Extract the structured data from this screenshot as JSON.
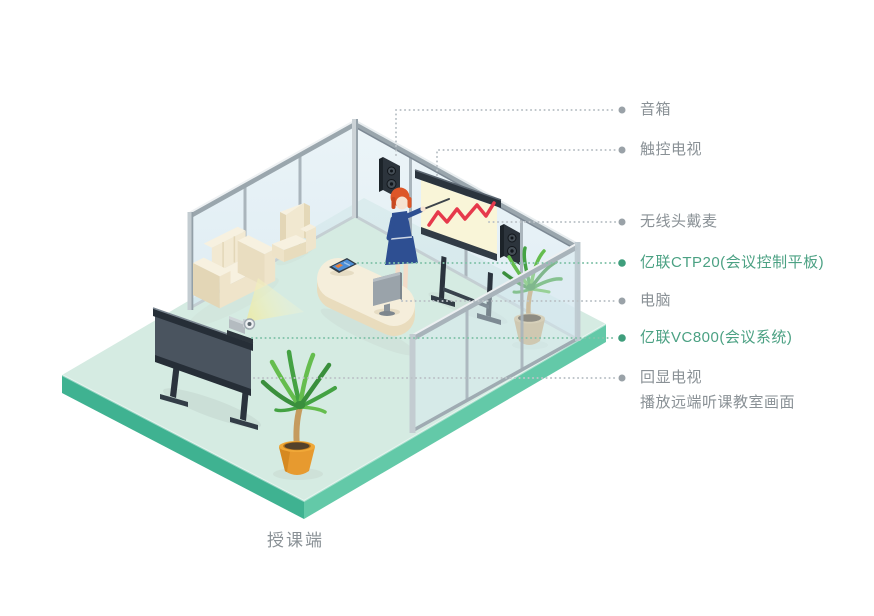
{
  "caption": {
    "text": "授课端"
  },
  "labels": [
    {
      "id": "speaker",
      "text": "音箱",
      "accent": false
    },
    {
      "id": "touch-tv",
      "text": "触控电视",
      "accent": false
    },
    {
      "id": "wireless-headset-mic",
      "text": "无线头戴麦",
      "accent": false
    },
    {
      "id": "yealink-ctp20",
      "text": "亿联CTP20(会议控制平板)",
      "accent": true
    },
    {
      "id": "computer",
      "text": "电脑",
      "accent": false
    },
    {
      "id": "yealink-vc800",
      "text": "亿联VC800(会议系统)",
      "accent": true
    },
    {
      "id": "echo-tv",
      "text": "回显电视",
      "sub": "播放远端听课教室画面",
      "accent": false
    }
  ],
  "colors": {
    "accent_green": "#4BA183",
    "label_gray": "#8A9196",
    "leader_dot_gray": "#9AA2A8",
    "leader_dot_green": "#3F9E7C",
    "platform_side_left": "#3FB291",
    "platform_side_right": "#63C9A8",
    "floor_mint": "#D5EBE2",
    "glass_blue": "#DCECF3",
    "sofa_cream": "#F2E9D3",
    "chart_red": "#E6394B",
    "dress_navy": "#2E4F92",
    "hair_orange": "#DD5628"
  }
}
